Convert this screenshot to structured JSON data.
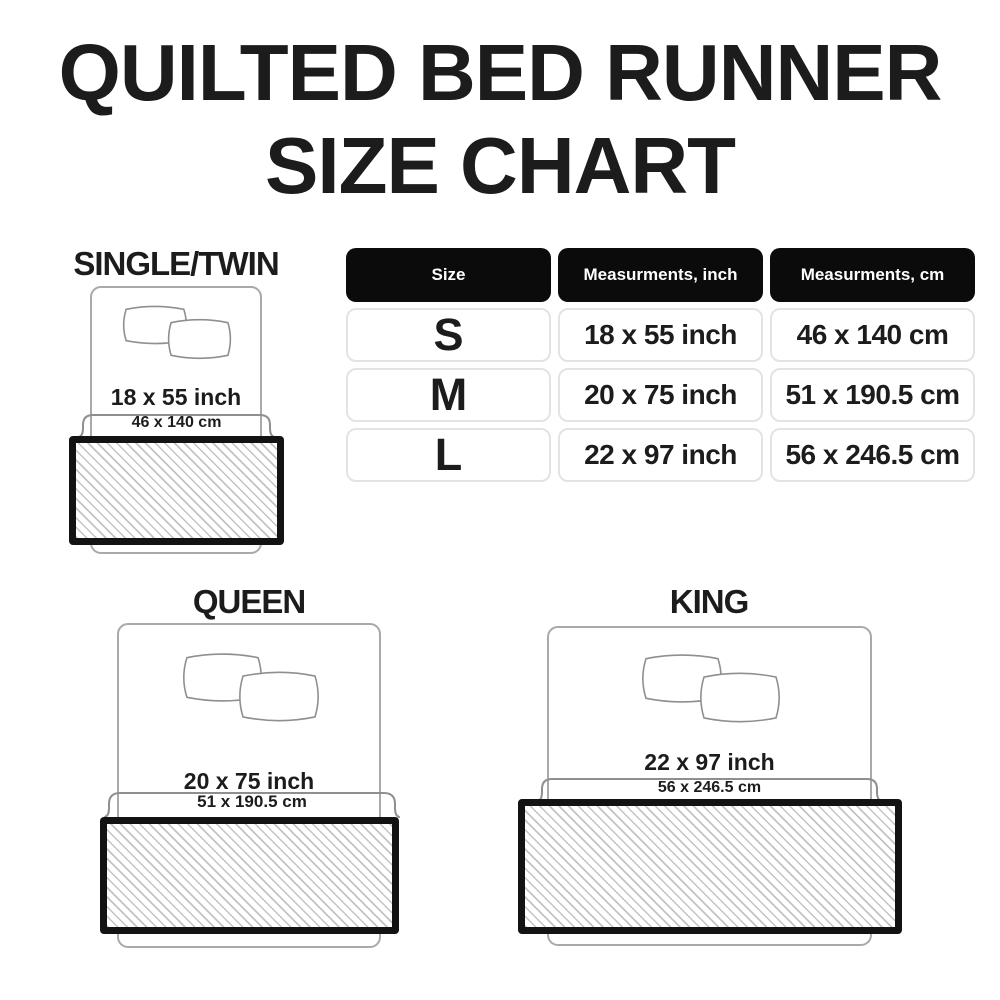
{
  "title": {
    "line1": "QUILTED BED RUNNER",
    "line2": "SIZE CHART"
  },
  "table": {
    "headers": [
      "Size",
      "Measurments, inch",
      "Measurments, cm"
    ],
    "rows": [
      {
        "size": "S",
        "inch": "18 x 55 inch",
        "cm": "46 x 140 cm"
      },
      {
        "size": "M",
        "inch": "20 x 75 inch",
        "cm": "51 x 190.5 cm"
      },
      {
        "size": "L",
        "inch": "22 x 97 inch",
        "cm": "56 x 246.5 cm"
      }
    ]
  },
  "diagrams": [
    {
      "label": "SINGLE/TWIN",
      "inch": "18 x 55 inch",
      "cm": "46 x 140 cm"
    },
    {
      "label": "QUEEN",
      "inch": "20 x 75 inch",
      "cm": "51 x 190.5 cm"
    },
    {
      "label": "KING",
      "inch": "22 x 97 inch",
      "cm": "56 x 246.5 cm"
    }
  ],
  "chart_data": {
    "type": "table",
    "title": "QUILTED BED RUNNER SIZE CHART",
    "columns": [
      "Size",
      "Measurments, inch",
      "Measurments, cm"
    ],
    "rows": [
      [
        "S",
        "18 x 55 inch",
        "46 x 140 cm"
      ],
      [
        "M",
        "20 x 75 inch",
        "51 x 190.5 cm"
      ],
      [
        "L",
        "22 x 97 inch",
        "56 x 246.5 cm"
      ]
    ],
    "annotations": [
      "SINGLE/TWIN uses S: 18 x 55 inch / 46 x 140 cm",
      "QUEEN uses M: 20 x 75 inch / 51 x 190.5 cm",
      "KING uses L: 22 x 97 inch / 56 x 246.5 cm"
    ]
  },
  "colors": {
    "text": "#1c1c1c",
    "table_header_bg": "#0b0b0b",
    "table_header_text": "#ffffff",
    "cell_border": "#e3e3e3",
    "outline_gray": "#a9a9a9",
    "hatch_line": "#c3c3c3",
    "runner_border": "#131313"
  }
}
